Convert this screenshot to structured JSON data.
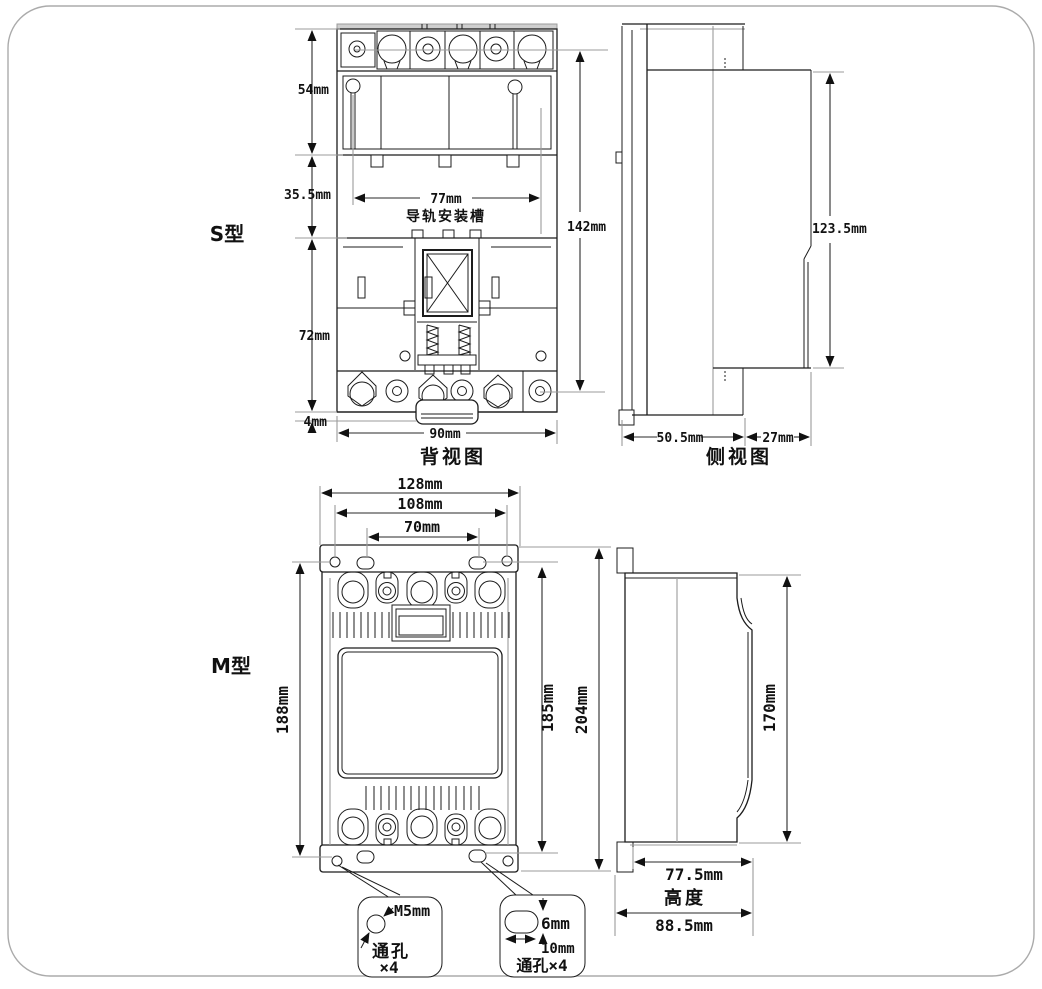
{
  "palette": {
    "line": "#1c1c1c",
    "reference_line": "#9b9b9b",
    "background": "#ffffff"
  },
  "s_type": {
    "label": "S型",
    "back_view": {
      "caption": "背视图",
      "rail_label": "导轨安装槽",
      "dim_54": "54mm",
      "dim_35_5": "35.5mm",
      "dim_72": "72mm",
      "dim_4": "4mm",
      "dim_77": "77mm",
      "dim_142": "142mm",
      "dim_90": "90mm"
    },
    "side_view": {
      "caption": "侧视图",
      "dim_123_5": "123.5mm",
      "dim_50_5": "50.5mm",
      "dim_27": "27mm"
    }
  },
  "m_type": {
    "label": "M型",
    "front_view": {
      "dim_128": "128mm",
      "dim_108": "108mm",
      "dim_70": "70mm",
      "dim_188": "188mm",
      "dim_185": "185mm",
      "dim_204": "204mm",
      "callout_m5": {
        "dim": "M5mm",
        "line1": "通孔",
        "line2": "×4"
      },
      "callout_slot": {
        "dim_6": "6mm",
        "dim_10": "10mm",
        "label": "通孔×4"
      }
    },
    "side_view": {
      "dim_170": "170mm",
      "dim_77_5": "77.5mm",
      "height_label": "高度",
      "dim_88_5": "88.5mm"
    }
  }
}
